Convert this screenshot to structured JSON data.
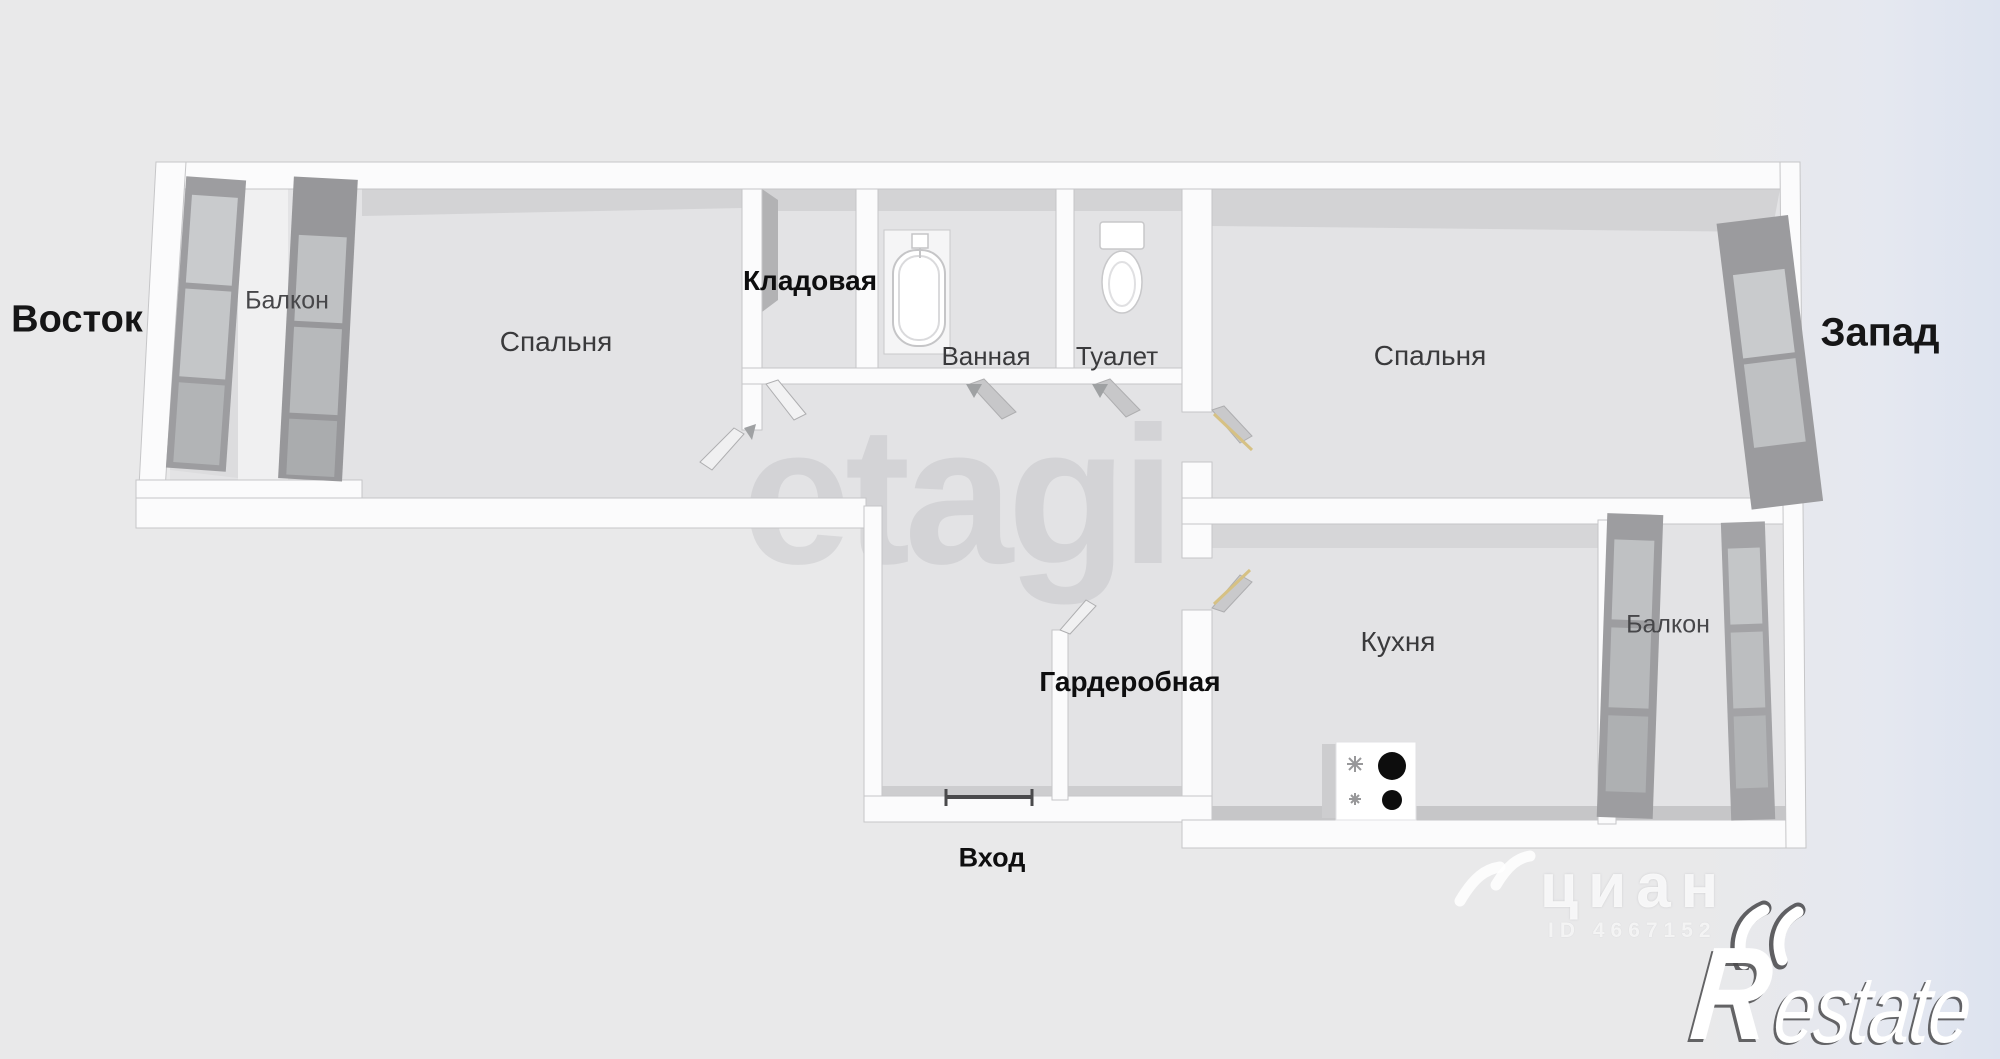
{
  "compass": {
    "east": "Восток",
    "west": "Запад"
  },
  "rooms": {
    "balcony_east": "Балкон",
    "bedroom_1": "Спальня",
    "storage": "Кладовая",
    "bathroom": "Ванная",
    "toilet": "Туалет",
    "bedroom_2": "Спальня",
    "wardrobe": "Гардеробная",
    "kitchen": "Кухня",
    "balcony_west": "Балкон",
    "entrance": "Вход"
  },
  "watermarks": {
    "center": "etagi",
    "portal": "циан",
    "listing_id": "ID 4667152",
    "agency_initial": "R",
    "agency_rest": "estate"
  },
  "fixtures": {
    "bathtub": "bathtub-icon",
    "toilet": "toilet-icon",
    "stove": "stove-icon",
    "entrance_door": "entrance-door-marker",
    "windows": "window-panel-icon"
  },
  "colors": {
    "background": "#e9e9ea",
    "background_right_tint": "#dde3ef",
    "floor": "#e3e3e5",
    "wall": "#fbfbfc",
    "wall_edge": "#c6c6c8",
    "inner_face": "#d3d3d5",
    "window_panel": "#9d9da0",
    "window_pane": "#c9cbcd",
    "label": "#3a3a3c",
    "label_bold": "#0e0e0f",
    "door_swing": "#d6c184",
    "burner_black": "#0d0d0d"
  }
}
